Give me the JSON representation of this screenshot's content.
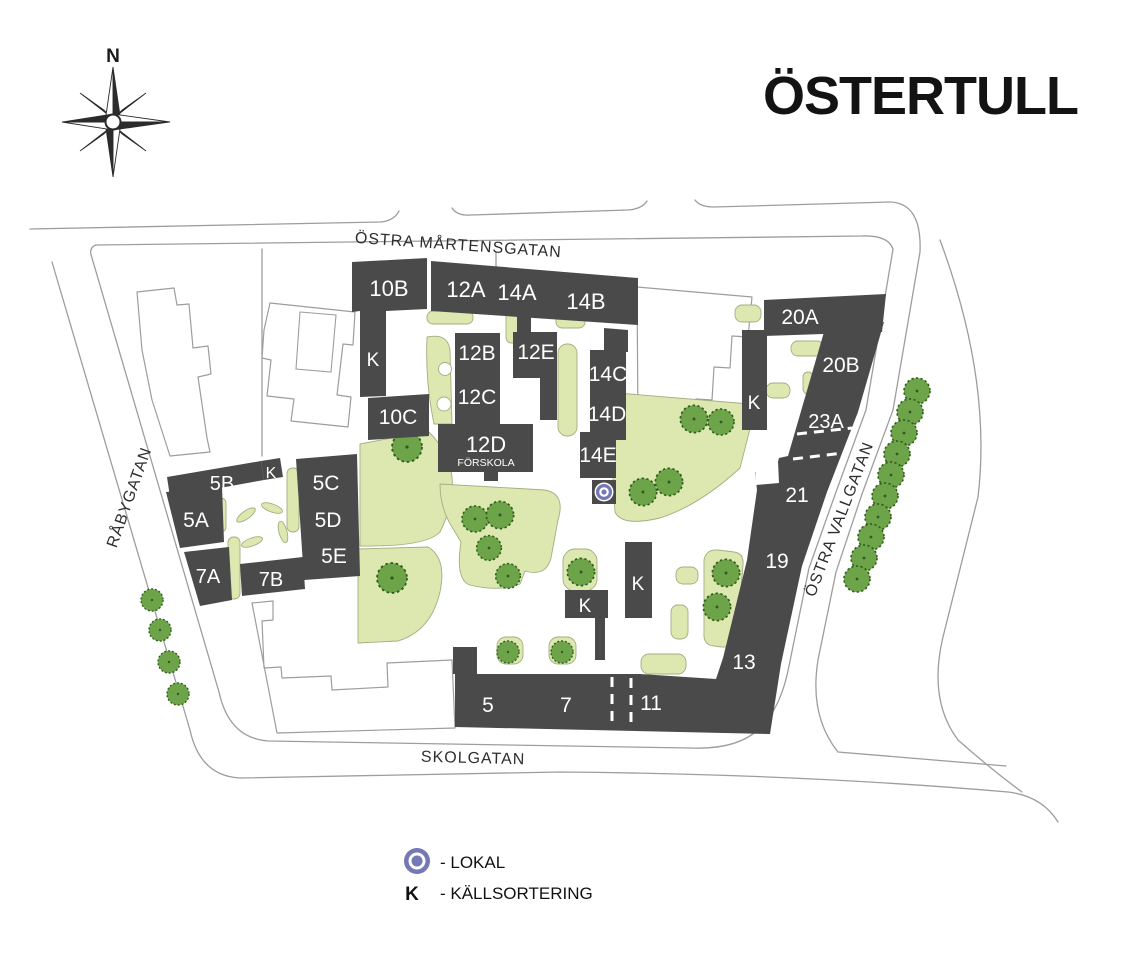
{
  "header": {
    "title": "ÖSTERTULL",
    "compass_label": "N"
  },
  "streets": {
    "top": "ÖSTRA MÅRTENSGATAN",
    "left": "RÅBYGATAN",
    "right": "ÖSTRA VALLGATAN",
    "bottom": "SKOLGATAN"
  },
  "map": {
    "buildings": {
      "b10B": "10B",
      "k_10b": "K",
      "b10C": "10C",
      "b12A": "12A",
      "b14A": "14A",
      "b14B": "14B",
      "b12B": "12B",
      "b12C": "12C",
      "b12E": "12E",
      "b12D": "12D",
      "b12D_sub": "FÖRSKOLA",
      "b14C": "14C",
      "b14D": "14D",
      "b14E": "14E",
      "b20A": "20A",
      "b20B": "20B",
      "k_20": "K",
      "b23A": "23A",
      "b21": "21",
      "b19": "19",
      "b13": "13",
      "b5": "5",
      "b7": "7",
      "b11": "11",
      "b5A": "5A",
      "b5B": "5B",
      "k_5b": "K",
      "b5C": "5C",
      "b5D": "5D",
      "b5E": "5E",
      "b7A": "7A",
      "b7B": "7B",
      "k_mid_small": "K",
      "k_mid_tall": "K"
    }
  },
  "legend": {
    "lokal_label": "- LOKAL",
    "kallsortering_symbol": "K",
    "kallsortering_label": "- KÄLLSORTERING"
  },
  "colors": {
    "background": "#ffffff",
    "building": "#4a4a4a",
    "green_area": "#dce8b0",
    "green_stroke": "#a4ad82",
    "tree_fill": "#6da44a",
    "tree_stroke": "#2f5c1a",
    "road_stroke": "#9d9d9d",
    "building_text": "#ffffff",
    "map_text": "#2e2e2e",
    "title_text": "#131313",
    "lokal_icon": "#7478b4"
  }
}
